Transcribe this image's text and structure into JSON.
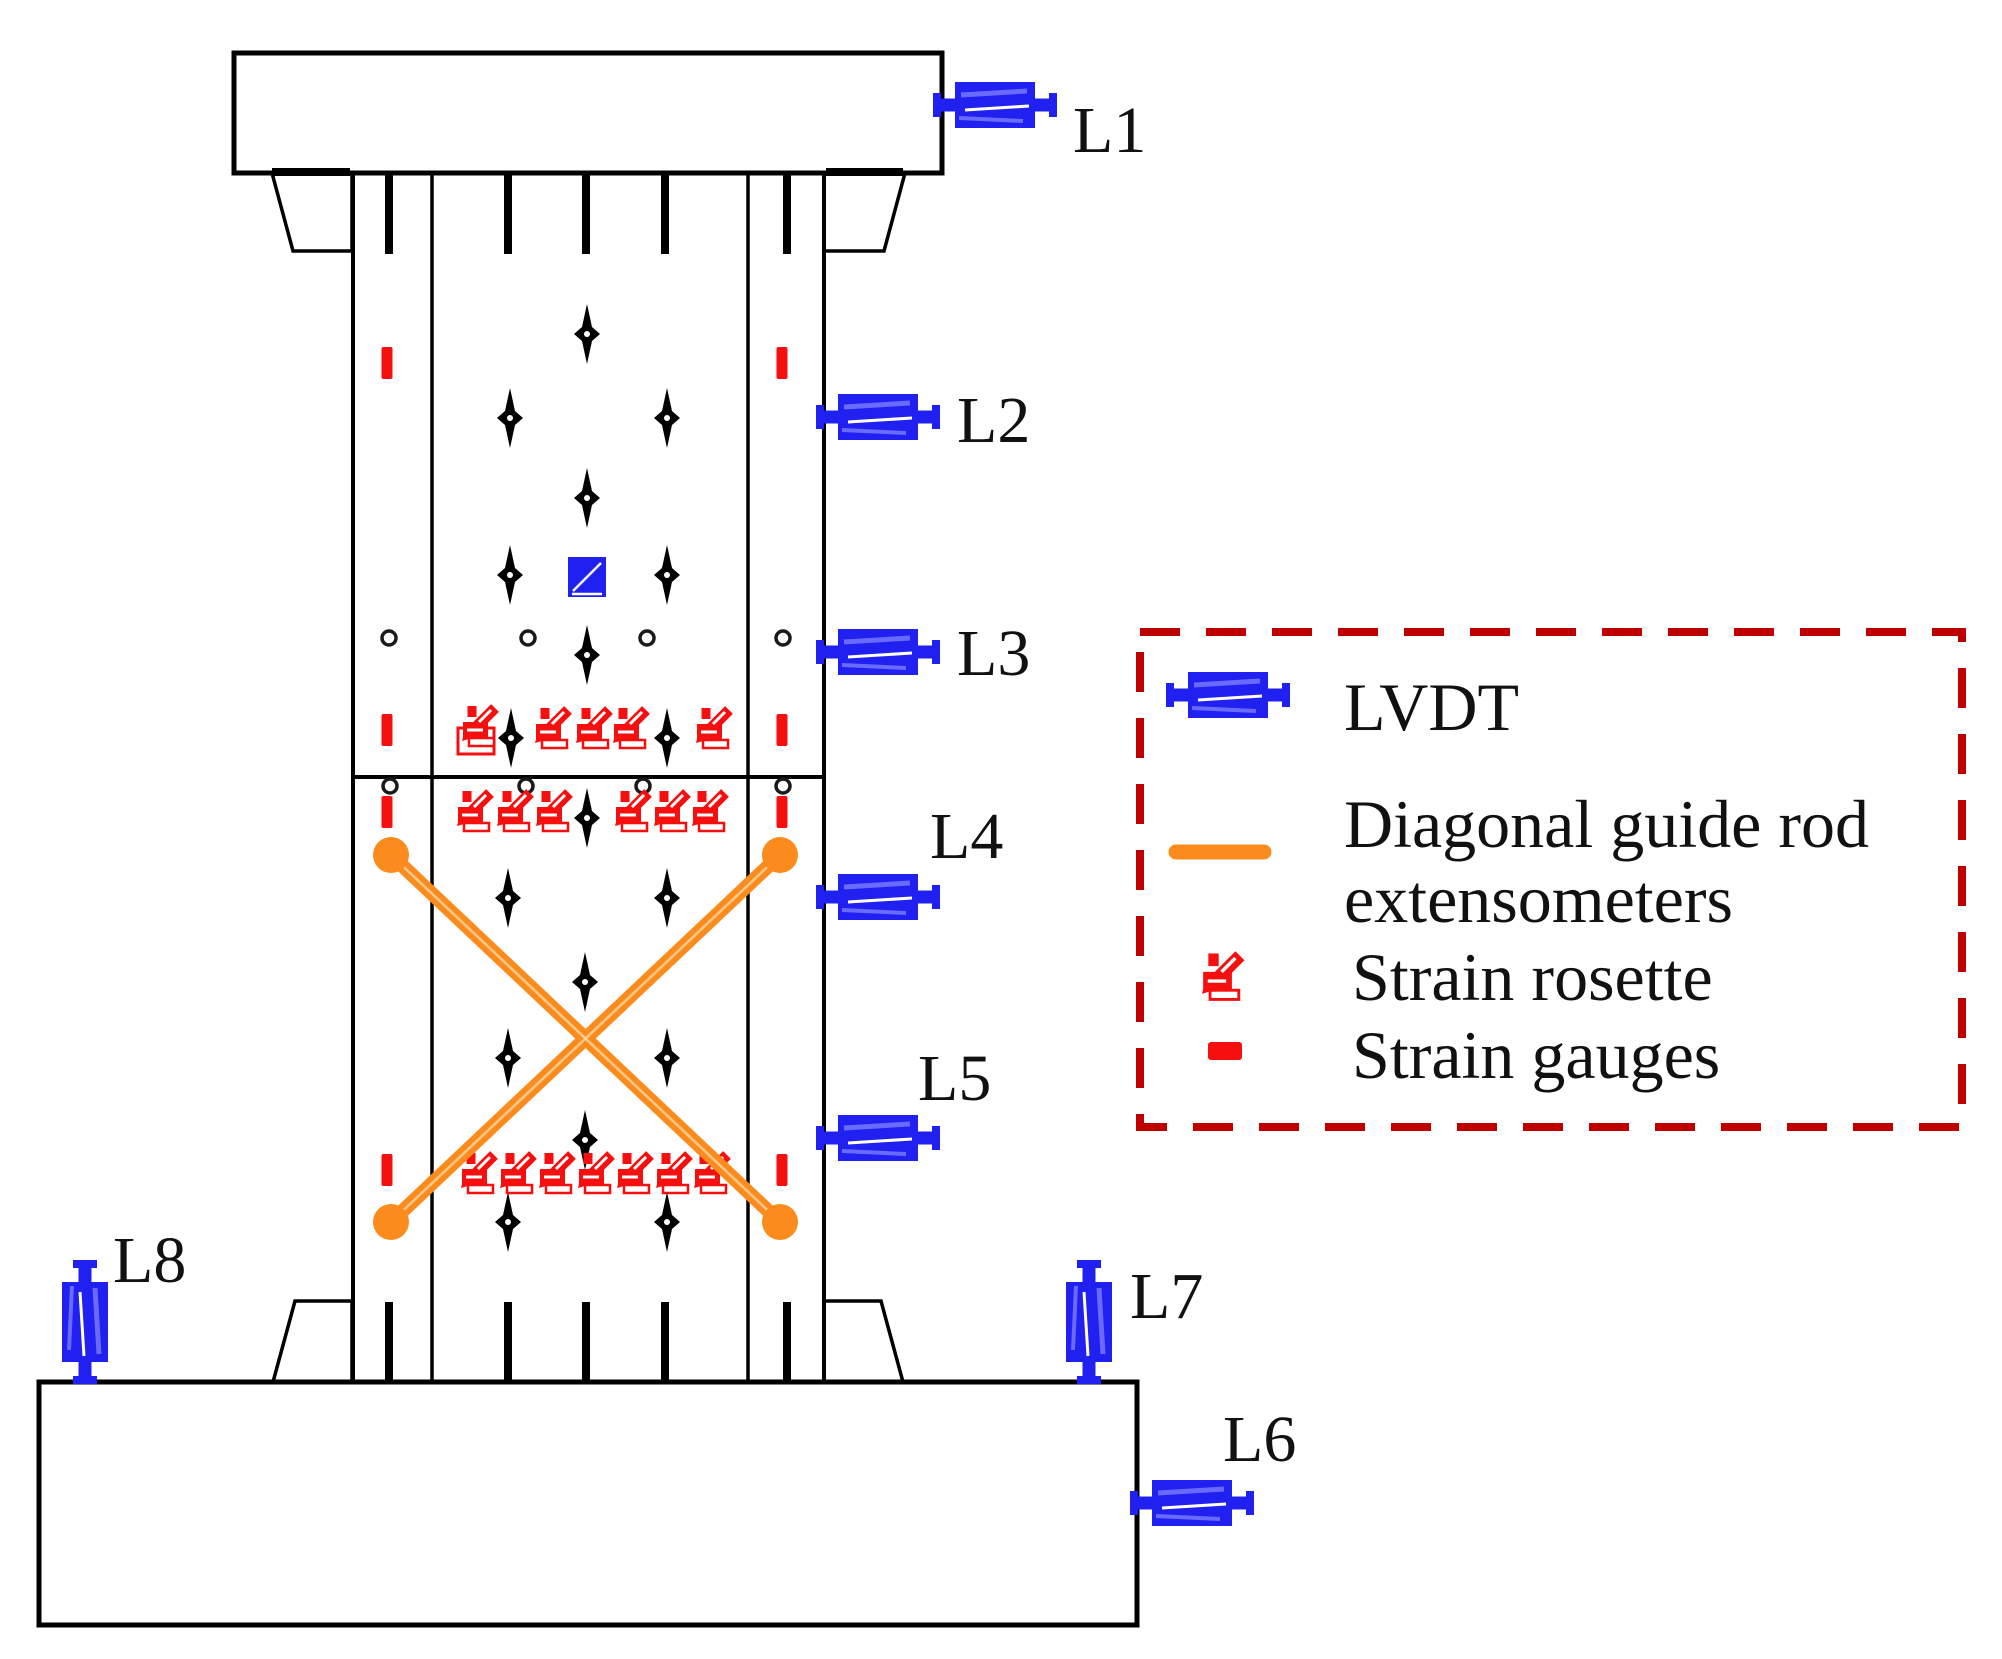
{
  "title": "Column specimen instrumentation diagram",
  "sensors": {
    "l1": {
      "label": "L1"
    },
    "l2": {
      "label": "L2"
    },
    "l3": {
      "label": "L3"
    },
    "l4": {
      "label": "L4"
    },
    "l5": {
      "label": "L5"
    },
    "l6": {
      "label": "L6"
    },
    "l7": {
      "label": "L7"
    },
    "l8": {
      "label": "L8"
    }
  },
  "legend": {
    "items": [
      {
        "icon": "lvdt-icon",
        "label": "LVDT"
      },
      {
        "icon": "extensometer-line-icon",
        "label_line1": "Diagonal guide rod",
        "label_line2": "extensometers"
      },
      {
        "icon": "strain-rosette-icon",
        "label": "Strain rosette"
      },
      {
        "icon": "strain-gauge-icon",
        "label": "Strain gauges"
      }
    ]
  },
  "colors": {
    "lvdt_blue": "#2020f0",
    "lvdt_blue_light": "#6a6aff",
    "strain_red": "#f50f0f",
    "extensometer_orange": "#fb8b1c",
    "legend_border_red": "#c00000",
    "black": "#000000"
  }
}
